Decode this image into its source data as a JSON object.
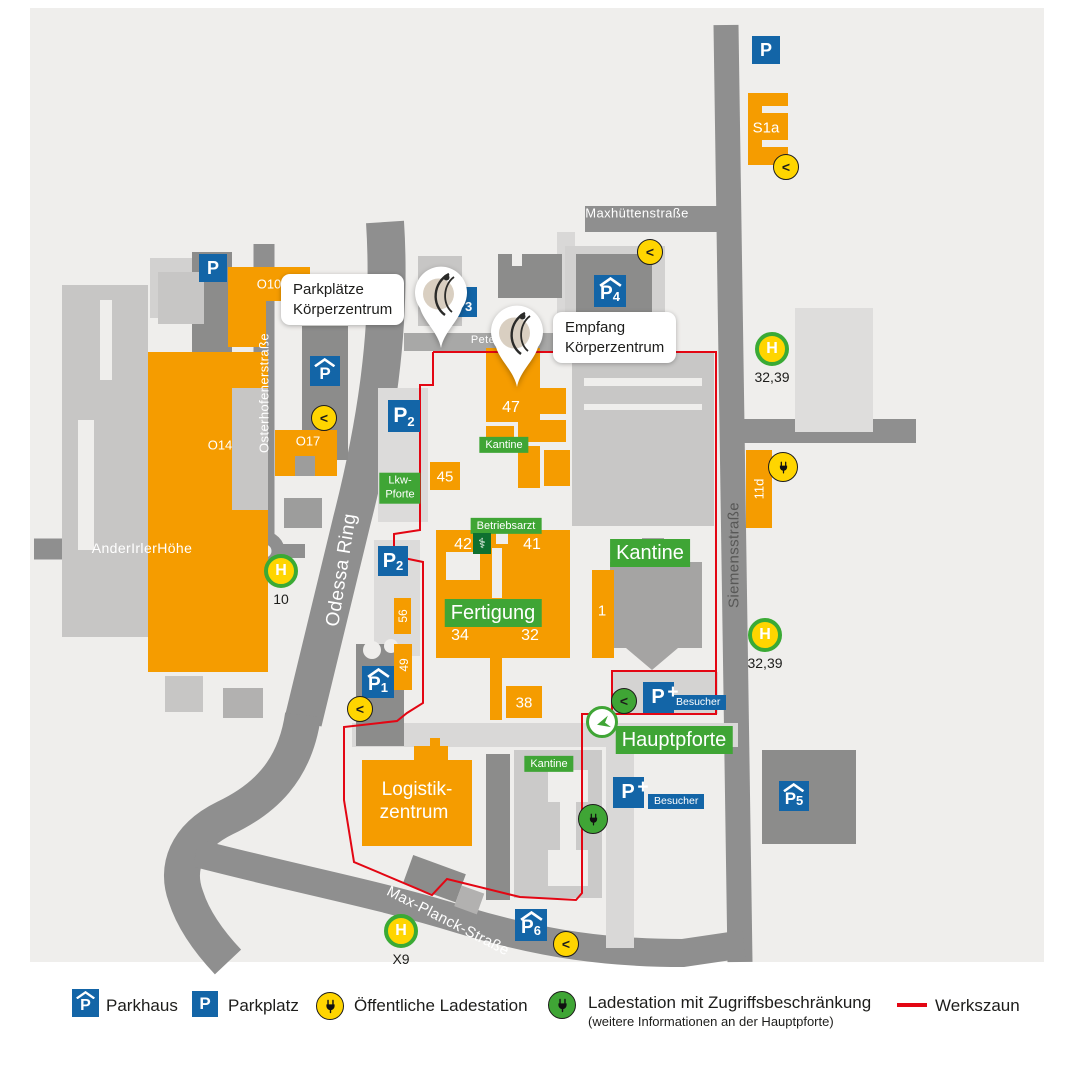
{
  "colors": {
    "orange": "#f59c00",
    "blue": "#1365a7",
    "green": "#3fa535",
    "dark_green": "#0e7030",
    "yellow": "#ffd500",
    "red_fence": "#e30613",
    "road": "#8f8f8f",
    "text_dark": "#1d1d1b",
    "street_text_dark": "#575756",
    "map_bg": "#efeeec"
  },
  "map": {
    "streets": [
      {
        "name": "Maxhüttenstraße",
        "x": 637,
        "y": 213,
        "rot": 0,
        "size": 13,
        "color": "#ffffff"
      },
      {
        "name": "Osterhofenerstraße",
        "x": 264,
        "y": 393,
        "rot": -90,
        "size": 13,
        "color": "#ffffff"
      },
      {
        "name": "AnderIrlerHöhe",
        "x": 142,
        "y": 548,
        "rot": 0,
        "size": 14,
        "color": "#ffffff"
      },
      {
        "name": "Odessa Ring",
        "x": 342,
        "y": 570,
        "rot": -81,
        "size": 19,
        "color": "#ffffff"
      },
      {
        "name": "Siemensstraße",
        "x": 734,
        "y": 555,
        "rot": -90,
        "size": 15,
        "color": "#575756"
      },
      {
        "name": "Max-Planck-Straße",
        "x": 448,
        "y": 921,
        "rot": 27,
        "size": 15,
        "color": "#ffffff"
      },
      {
        "name": "Pete",
        "x": 483,
        "y": 340,
        "rot": 0,
        "size": 11,
        "color": "#ffffff"
      }
    ],
    "building_labels": [
      {
        "text": "S1a",
        "x": 766,
        "y": 128,
        "size": 15
      },
      {
        "text": "O10",
        "x": 269,
        "y": 284,
        "size": 13
      },
      {
        "text": "O14",
        "x": 220,
        "y": 445,
        "size": 13
      },
      {
        "text": "O17",
        "x": 308,
        "y": 441,
        "size": 13
      },
      {
        "text": "47",
        "x": 511,
        "y": 408,
        "size": 16
      },
      {
        "text": "45",
        "x": 445,
        "y": 477,
        "size": 15
      },
      {
        "text": "42",
        "x": 463,
        "y": 545,
        "size": 16
      },
      {
        "text": "41",
        "x": 532,
        "y": 545,
        "size": 16
      },
      {
        "text": "34",
        "x": 460,
        "y": 636,
        "size": 16
      },
      {
        "text": "32",
        "x": 530,
        "y": 636,
        "size": 16
      },
      {
        "text": "38",
        "x": 524,
        "y": 703,
        "size": 15
      },
      {
        "text": "1",
        "x": 602,
        "y": 611,
        "size": 15
      },
      {
        "text": "56",
        "x": 403,
        "y": 616,
        "size": 12,
        "rot": -90
      },
      {
        "text": "49",
        "x": 404,
        "y": 665,
        "size": 12,
        "rot": -90
      },
      {
        "text": "11d",
        "x": 759,
        "y": 489,
        "size": 13,
        "rot": -90
      },
      {
        "text": "Logistik-",
        "x": 417,
        "y": 790,
        "size": 19
      },
      {
        "text": "zentrum",
        "x": 414,
        "y": 813,
        "size": 19
      }
    ],
    "green_labels": [
      {
        "lines": [
          "Kantine"
        ],
        "x": 504,
        "y": 445,
        "size": 11
      },
      {
        "lines": [
          "Betriebsarzt"
        ],
        "x": 506,
        "y": 526,
        "size": 11
      },
      {
        "lines": [
          "Fertigung"
        ],
        "x": 493,
        "y": 613,
        "size": 20
      },
      {
        "lines": [
          "Kantine"
        ],
        "x": 650,
        "y": 553,
        "size": 20
      },
      {
        "lines": [
          "Hauptpforte"
        ],
        "x": 674,
        "y": 740,
        "size": 20
      },
      {
        "lines": [
          "Kantine"
        ],
        "x": 549,
        "y": 764,
        "size": 11
      },
      {
        "lines": [
          "Lkw-",
          "Pforte"
        ],
        "x": 400,
        "y": 488,
        "size": 11
      }
    ],
    "parking_signs": [
      {
        "label": "P",
        "sub": "",
        "roof": false,
        "x": 766,
        "y": 50,
        "s": 28
      },
      {
        "label": "P",
        "sub": "",
        "roof": false,
        "x": 213,
        "y": 268,
        "s": 28
      },
      {
        "label": "P",
        "sub": "",
        "roof": true,
        "x": 325,
        "y": 371,
        "s": 30
      },
      {
        "label": "P",
        "sub": "2",
        "roof": false,
        "x": 404,
        "y": 416,
        "s": 32
      },
      {
        "label": "P",
        "sub": "2",
        "roof": false,
        "x": 393,
        "y": 561,
        "s": 30
      },
      {
        "label": "P",
        "sub": "4",
        "roof": true,
        "x": 610,
        "y": 291,
        "s": 32
      },
      {
        "label": "P",
        "sub": "1",
        "roof": true,
        "x": 378,
        "y": 682,
        "s": 32
      },
      {
        "label": "P",
        "sub": "5",
        "roof": true,
        "x": 794,
        "y": 796,
        "s": 30
      },
      {
        "label": "P",
        "sub": "6",
        "roof": true,
        "x": 531,
        "y": 925,
        "s": 32
      },
      {
        "label": "P",
        "sub": "3",
        "roof": false,
        "x": 462,
        "y": 302,
        "s": 30
      },
      {
        "label": "P",
        "sub": "",
        "roof": false,
        "plus": "+",
        "x": 658,
        "y": 697,
        "s": 31
      },
      {
        "label": "P",
        "sub": "",
        "roof": false,
        "plus": "+",
        "x": 628,
        "y": 792,
        "s": 31
      }
    ],
    "visitor_tags": [
      {
        "text": "Besucher",
        "x": 670,
        "y": 695
      },
      {
        "text": "Besucher",
        "x": 648,
        "y": 794
      }
    ],
    "h_stops": [
      {
        "h": "H",
        "label": "32,39",
        "x": 772,
        "y": 349
      },
      {
        "h": "H",
        "label": "32,39",
        "x": 765,
        "y": 635
      },
      {
        "h": "H",
        "label": "10",
        "x": 281,
        "y": 571
      },
      {
        "h": "H",
        "label": "X9",
        "x": 401,
        "y": 931
      }
    ],
    "charging_stations": [
      {
        "x": 786,
        "y": 167,
        "color": "yellow",
        "glyph": "<"
      },
      {
        "x": 650,
        "y": 252,
        "color": "yellow",
        "glyph": "<"
      },
      {
        "x": 324,
        "y": 418,
        "color": "yellow",
        "glyph": "<"
      },
      {
        "x": 783,
        "y": 467,
        "color": "yellow",
        "glyph": "plug"
      },
      {
        "x": 360,
        "y": 709,
        "color": "yellow",
        "glyph": "<"
      },
      {
        "x": 566,
        "y": 944,
        "color": "yellow",
        "glyph": "<"
      },
      {
        "x": 624,
        "y": 701,
        "color": "green",
        "glyph": "<"
      },
      {
        "x": 593,
        "y": 819,
        "color": "green",
        "glyph": "plug"
      }
    ],
    "gate": {
      "x": 602,
      "y": 722
    },
    "medical": {
      "symbol": "⚕",
      "x": 482,
      "y": 543
    },
    "callouts": [
      {
        "lines": [
          "Parkplätze",
          "Körperzentrum"
        ]
      },
      {
        "lines": [
          "Empfang",
          "Körperzentrum"
        ]
      }
    ]
  },
  "legend": {
    "p_letter": "P",
    "items": [
      {
        "icon": "parkhaus-icon",
        "label": "Parkhaus"
      },
      {
        "icon": "parkplatz-icon",
        "label": "Parkplatz"
      },
      {
        "icon": "public-charging-icon",
        "label": "Öffentliche Ladestation"
      },
      {
        "icon": "restricted-charging-icon",
        "label": "Ladestation mit Zugriffsbeschränkung",
        "sub": "(weitere Informationen an der Hauptpforte)"
      },
      {
        "icon": "fence-line",
        "label": "Werkszaun"
      }
    ]
  }
}
